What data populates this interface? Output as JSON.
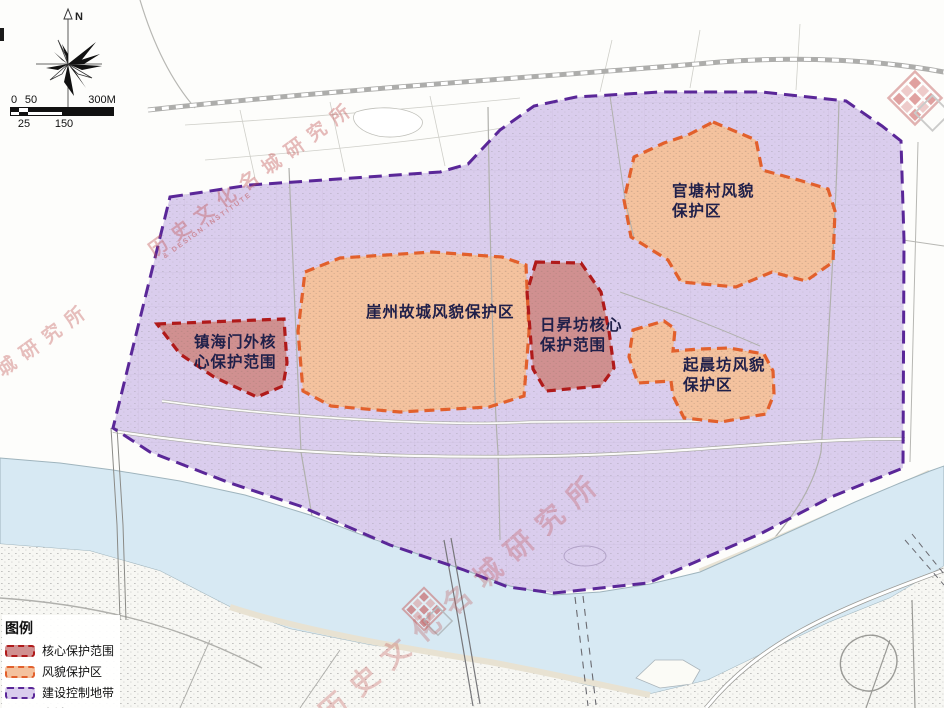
{
  "map_labels": {
    "yazhou": "崖州故城风貌保护区",
    "risheng": "日昇坊核心\n保护范围",
    "guantang": "官塘村风貌\n保护区",
    "qichen": "起晨坊风貌\n保护区",
    "zhenhai": "镇海门外核\n心保护范围"
  },
  "legend": {
    "title": "图例",
    "items": [
      {
        "label": "核心保护范围"
      },
      {
        "label": "风貌保护区"
      },
      {
        "label": "建设控制地带"
      },
      {
        "label": "水域"
      }
    ]
  },
  "compass": {
    "north_label": "N"
  },
  "scale_bar": {
    "top_labels": [
      "0",
      "50",
      "300M"
    ],
    "bottom_labels": [
      "25",
      "150"
    ]
  },
  "watermark": {
    "cn": "历史文化名城研究所",
    "en": "& DESIGN INSTITUTE"
  },
  "colors": {
    "core_fill": "#d09090",
    "core_border": "#b01a1a",
    "style_fill": "#f4c29e",
    "style_border": "#e2602c",
    "control_fill": "#dacded",
    "control_border": "#5a2798",
    "water_fill": "#d7e9f3",
    "watermark": "#c05050",
    "label_text": "#20204a"
  }
}
